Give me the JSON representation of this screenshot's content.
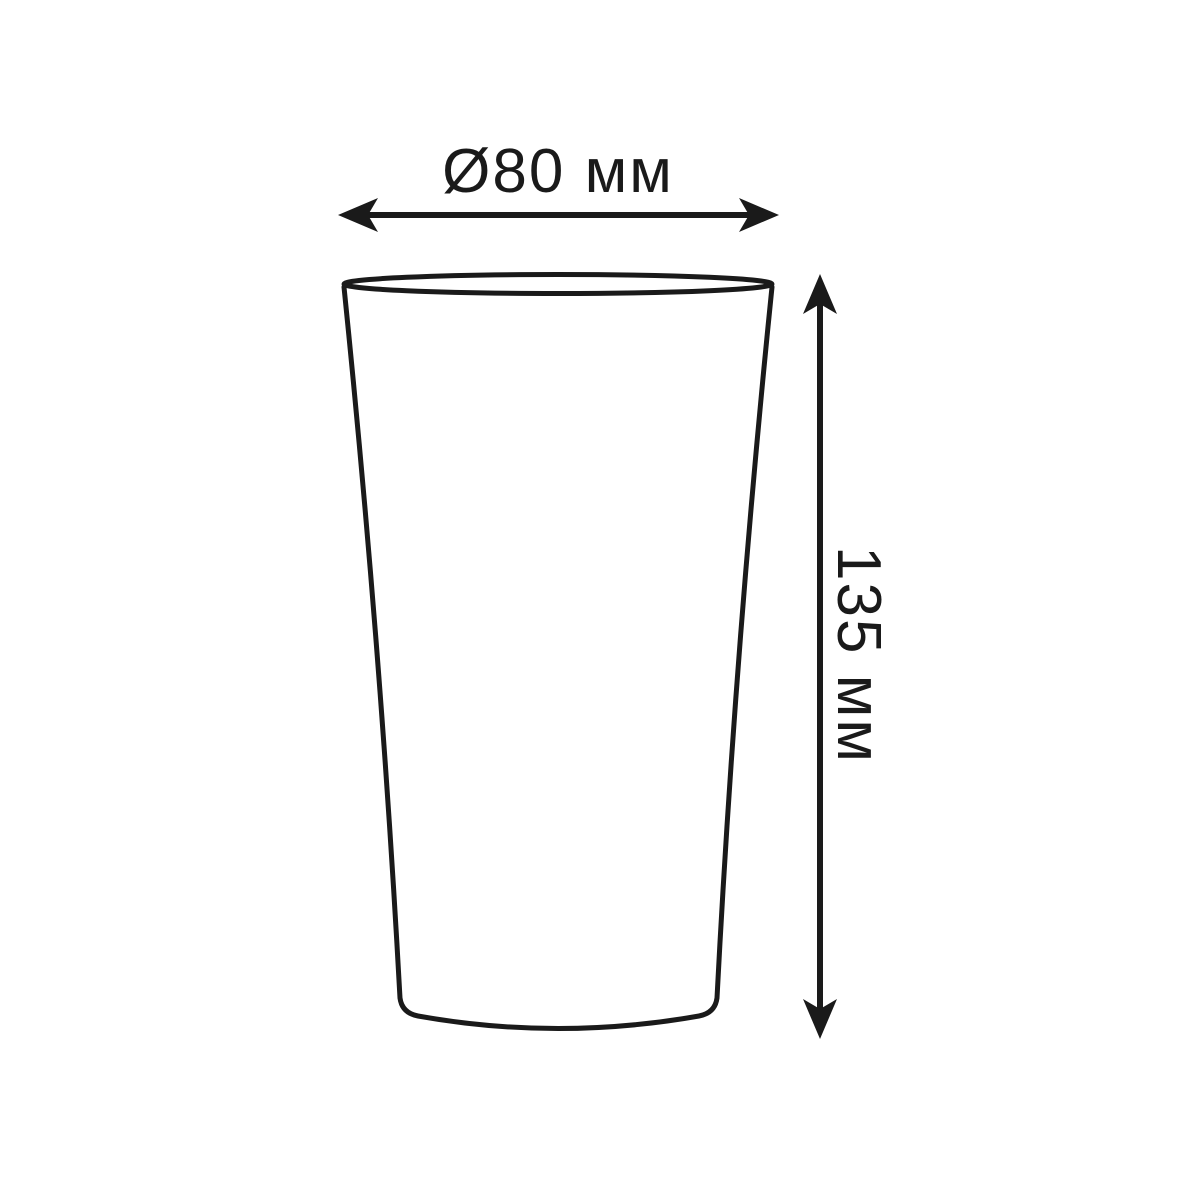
{
  "diagram": {
    "type": "technical-drawing",
    "subject": "tapered cup / tumbler outline with dimension callouts",
    "background_color": "#ffffff",
    "line_color": "#1a1a1a",
    "width_dimension": {
      "label": "Ø80 мм",
      "symbol": "Ø",
      "value": 80,
      "unit": "мм",
      "orientation": "horizontal"
    },
    "height_dimension": {
      "label": "135 мм",
      "value": 135,
      "unit": "мм",
      "orientation": "vertical"
    }
  }
}
